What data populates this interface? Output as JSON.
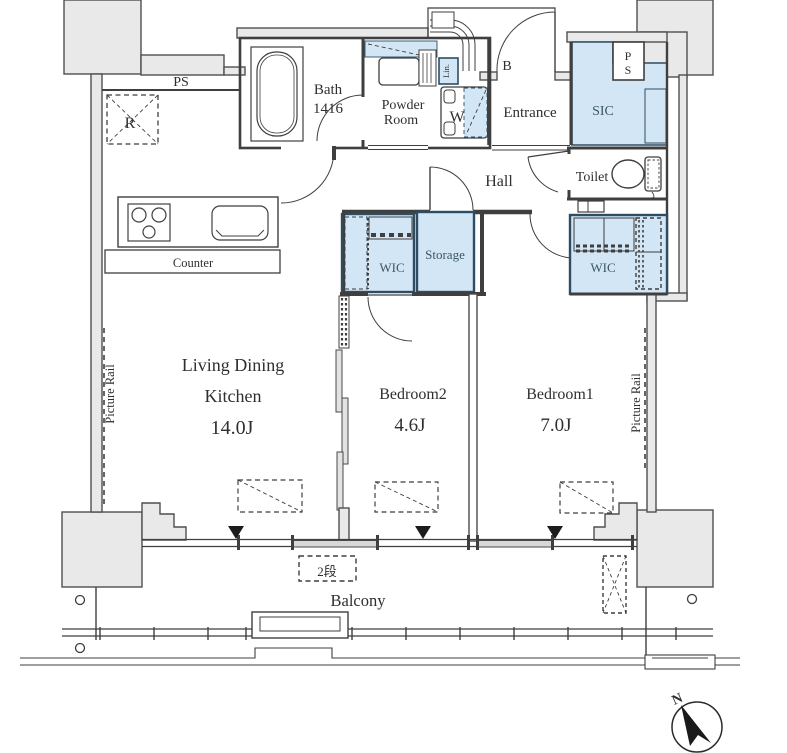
{
  "title": "Apartment floor plan 2LDK",
  "colors": {
    "wall_fill": "#e9e9e9",
    "wall_stroke": "#4f4f4f",
    "line": "#3f3f3f",
    "closet_fill": "#d3e6f5",
    "closet_stroke": "#2e4d63",
    "text": "#2f2f2f",
    "closet_text": "#3a5668"
  },
  "labels": {
    "ps_top": "PS",
    "refrigerator": "R",
    "bath": "Bath",
    "bath_size": "1416",
    "powder_line1": "Powder",
    "powder_line2": "Room",
    "linen": "Lin.",
    "washer": "W",
    "b_mark": "B",
    "entrance": "Entrance",
    "sic": "SIC",
    "ps_right_p": "P",
    "ps_right_s": "S",
    "hall": "Hall",
    "toilet": "Toilet",
    "wic_bedroom2": "WIC",
    "storage": "Storage",
    "wic_bedroom1": "WIC",
    "ldk_line1": "Living Dining",
    "ldk_line2": "Kitchen",
    "ldk_size": "14.0J",
    "counter": "Counter",
    "bedroom2": "Bedroom2",
    "bedroom2_size": "4.6J",
    "bedroom1": "Bedroom1",
    "bedroom1_size": "7.0J",
    "picture_rail_left": "Picture Rail",
    "picture_rail_right": "Picture Rail",
    "balcony": "Balcony",
    "two_steps": "2段",
    "north": "N"
  },
  "rooms": [
    {
      "name": "Living Dining Kitchen",
      "size": "14.0J"
    },
    {
      "name": "Bedroom2",
      "size": "4.6J"
    },
    {
      "name": "Bedroom1",
      "size": "7.0J"
    },
    {
      "name": "Bath",
      "size": "1416"
    }
  ]
}
